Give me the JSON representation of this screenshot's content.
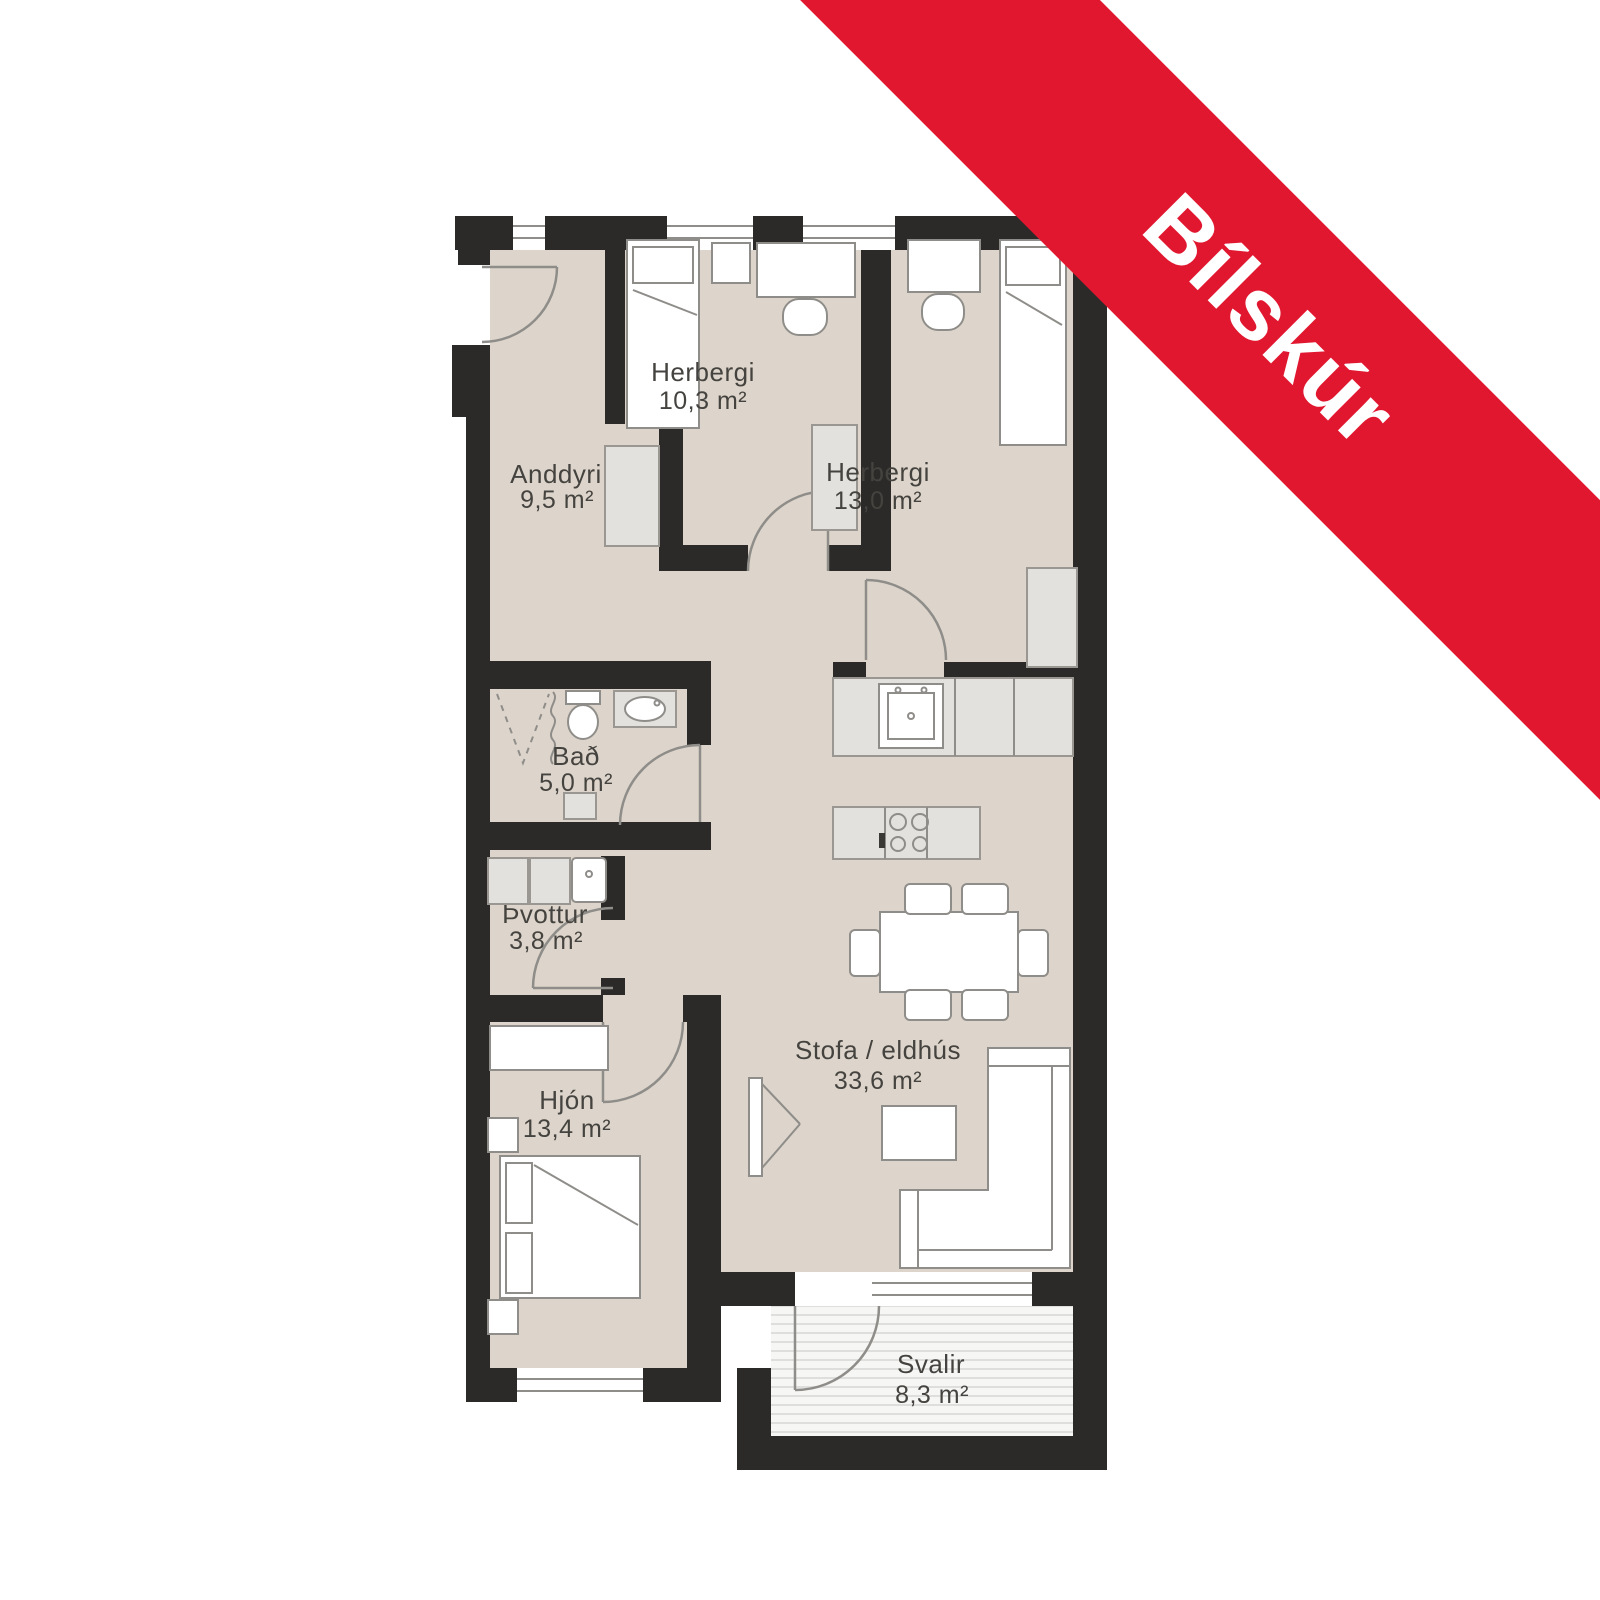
{
  "ribbon": {
    "label": "Bílskúr",
    "color": "#e11730"
  },
  "rooms": [
    {
      "id": "anddyri",
      "name": "Anddyri",
      "area": "9,5 m²"
    },
    {
      "id": "herbergi-1",
      "name": "Herbergi",
      "area": "10,3 m²"
    },
    {
      "id": "herbergi-2",
      "name": "Herbergi",
      "area": "13,0 m²"
    },
    {
      "id": "bad",
      "name": "Bað",
      "area": "5,0 m²"
    },
    {
      "id": "thvottur",
      "name": "Þvottur",
      "area": "3,8 m²"
    },
    {
      "id": "hjon",
      "name": "Hjón",
      "area": "13,4 m²"
    },
    {
      "id": "stofa",
      "name": "Stofa / eldhús",
      "area": "33,6 m²"
    },
    {
      "id": "svalir",
      "name": "Svalir",
      "area": "8,3 m²"
    }
  ],
  "colors": {
    "wall": "#2b2a28",
    "floor": "#ddd5cb",
    "ribbon_red": "#e11730",
    "furniture_outline": "#8f8d89"
  }
}
